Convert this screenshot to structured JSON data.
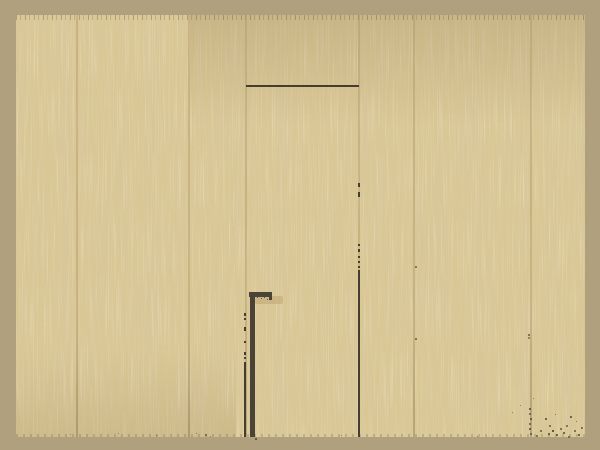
{
  "scene": {
    "name": "wooden-wall-with-hidden-door-and-cane",
    "type": "pixel-art game scene",
    "visible_text": [],
    "colors": {
      "frame": "#b1a07e",
      "wall": "#d9c795",
      "grain_dark": "#b3996a",
      "grain_light": "#eadfb0",
      "seam": "#a98f5f",
      "outline": "#453d2f",
      "cane": "#4b4335",
      "shadow": "#b49a66"
    },
    "objects": [
      {
        "name": "plank-wall",
        "description": "wall of vertical wooden planks, alternating narrow and wide boards"
      },
      {
        "name": "hidden-door",
        "description": "flush concealed door outlined by plank seams with a dark top edge"
      },
      {
        "name": "cane",
        "description": "dark walking cane leaning against the wall beside the door seam"
      },
      {
        "name": "dirt-speckles",
        "description": "scattered dark specks near the floor, densest at bottom right"
      }
    ]
  }
}
